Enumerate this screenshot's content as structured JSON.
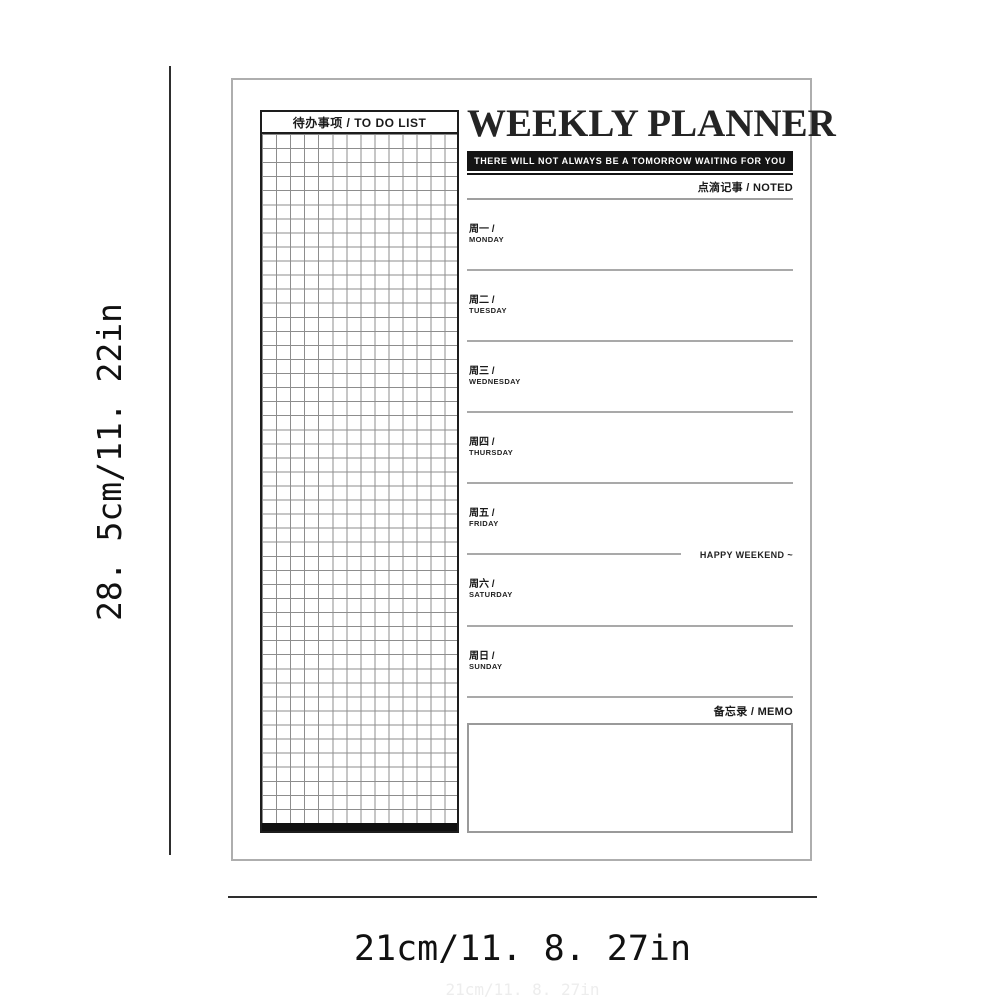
{
  "dimensions": {
    "height_label": "28. 5cm/11. 22in",
    "width_label": "21cm/11. 8. 27in",
    "width_label_faint": "21cm/11. 8. 27in"
  },
  "planner": {
    "title": "WEEKLY PLANNER",
    "tagline": "THERE WILL NOT ALWAYS BE A TOMORROW WAITING FOR YOU",
    "noted_label": "点滴记事 / NOTED",
    "memo_label": "备忘录 / MEMO",
    "weekend_note": "HAPPY WEEKEND ~",
    "todo_header": "待办事项 / TO DO LIST",
    "days": [
      {
        "cn": "周一 /",
        "en": "MONDAY"
      },
      {
        "cn": "周二 /",
        "en": "TUESDAY"
      },
      {
        "cn": "周三 /",
        "en": "WEDNESDAY"
      },
      {
        "cn": "周四 /",
        "en": "THURSDAY"
      },
      {
        "cn": "周五 /",
        "en": "FRIDAY"
      },
      {
        "cn": "周六 /",
        "en": "SATURDAY"
      },
      {
        "cn": "周日 /",
        "en": "SUNDAY"
      }
    ]
  },
  "colors": {
    "ink": "#1a1a1a",
    "tagline_bar": "#141414",
    "rule_line": "#a9a9a9",
    "grid_line": "#8d8d8d",
    "sheet_border": "#aeaeae",
    "dimension_line": "#2e2e2e"
  }
}
